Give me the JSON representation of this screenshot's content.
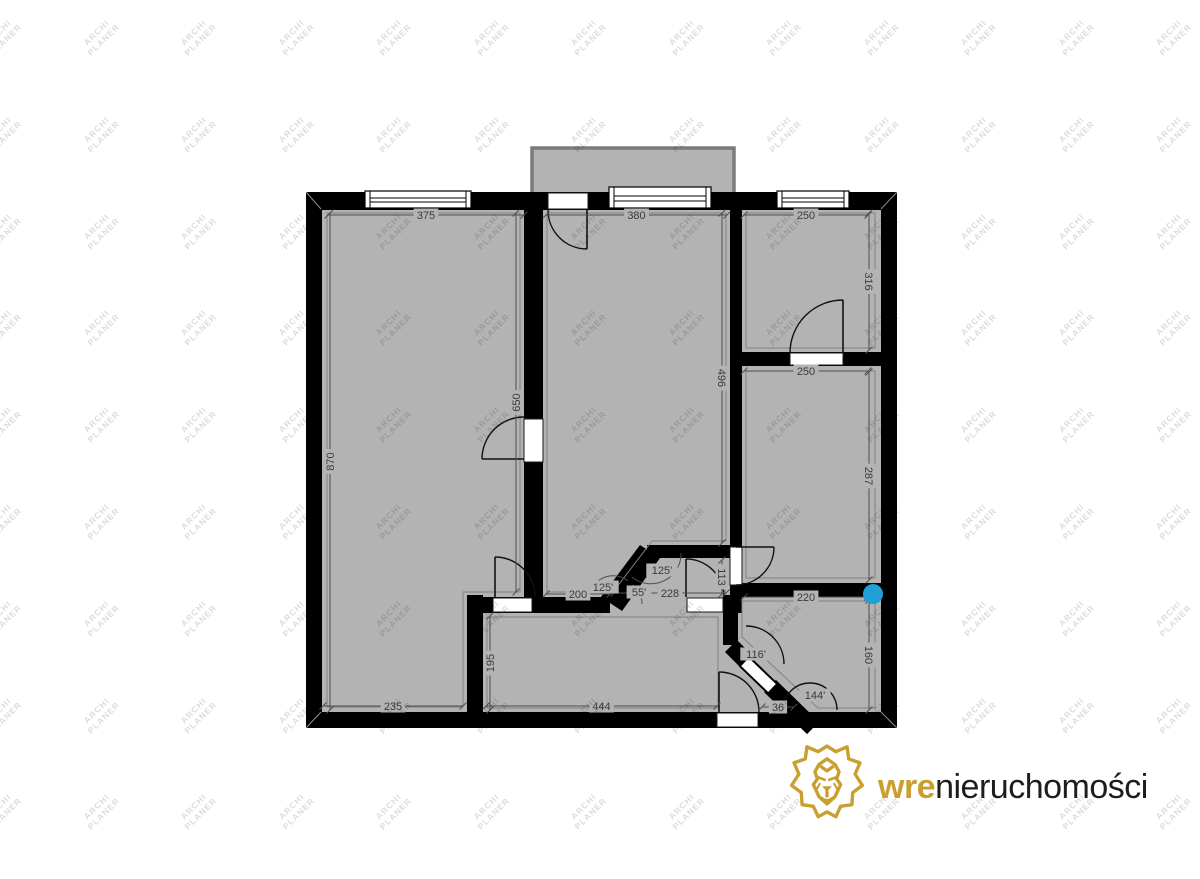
{
  "branding": {
    "watermark_line1": "ARCHI",
    "watermark_line2": "PLANER",
    "logo_bold": "wre",
    "logo_rest": "nieruchomości"
  },
  "colors": {
    "wall": "#000000",
    "room_fill": "#b3b3b3",
    "balcony_border": "#7b7b7b",
    "room_outline": "#828282",
    "dim_line": "#4f4f4f",
    "dim_text": "#3b3b3b",
    "watermark": "rgba(0,0,0,0.14)",
    "marker_blue": "#219fd9",
    "logo_gold": "#c9a02f",
    "logo_dark": "#1d1d1b"
  },
  "plan": {
    "horizontal_dimensions": [
      {
        "label": "375",
        "x1": 328,
        "x2": 524,
        "y": 215
      },
      {
        "label": "380",
        "x1": 546,
        "x2": 727,
        "y": 215
      },
      {
        "label": "250",
        "x1": 744,
        "x2": 868,
        "y": 215
      },
      {
        "label": "250",
        "x1": 744,
        "x2": 868,
        "y": 371
      },
      {
        "label": "200",
        "x1": 546,
        "x2": 610,
        "y": 594
      },
      {
        "label": "228",
        "x1": 614,
        "x2": 726,
        "y": 593
      },
      {
        "label": "220",
        "x1": 744,
        "x2": 868,
        "y": 597
      },
      {
        "label": "235",
        "x1": 323,
        "x2": 463,
        "y": 706
      },
      {
        "label": "444",
        "x1": 486,
        "x2": 717,
        "y": 706
      },
      {
        "label": "36",
        "x1": 762,
        "x2": 794,
        "y": 707
      }
    ],
    "vertical_dimensions": [
      {
        "label": "870",
        "x": 330,
        "y1": 213,
        "y2": 710,
        "rot": -90
      },
      {
        "label": "650",
        "x": 516,
        "y1": 213,
        "y2": 592,
        "rot": -90
      },
      {
        "label": "496",
        "x": 722,
        "y1": 213,
        "y2": 543,
        "rot": 90
      },
      {
        "label": "316",
        "x": 869,
        "y1": 213,
        "y2": 350,
        "rot": 90
      },
      {
        "label": "287",
        "x": 869,
        "y1": 372,
        "y2": 580,
        "rot": 90
      },
      {
        "label": "113",
        "x": 722,
        "y1": 560,
        "y2": 594,
        "rot": 90
      },
      {
        "label": "160",
        "x": 869,
        "y1": 600,
        "y2": 710,
        "rot": 90
      },
      {
        "label": "195",
        "x": 490,
        "y1": 616,
        "y2": 710,
        "rot": -90
      }
    ],
    "angle_labels": [
      {
        "label": "125'",
        "x": 603,
        "y": 587
      },
      {
        "label": "55'",
        "x": 639,
        "y": 592
      },
      {
        "label": "125'",
        "x": 662,
        "y": 570
      },
      {
        "label": "116'",
        "x": 756,
        "y": 654
      },
      {
        "label": "144'",
        "x": 815,
        "y": 695
      }
    ],
    "marker": {
      "x": 873,
      "y": 594,
      "r": 10
    }
  }
}
